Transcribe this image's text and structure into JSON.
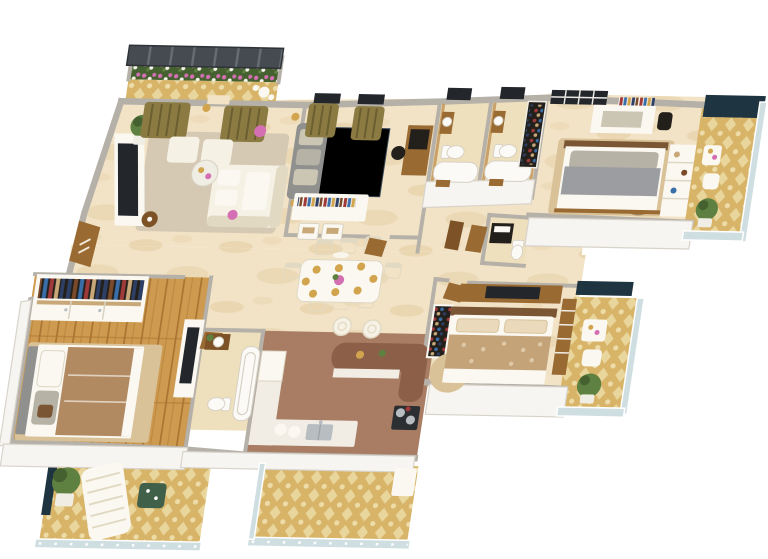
{
  "meta": {
    "view": "3d-isometric-floor-plan",
    "units_note": "no text rendered in source image"
  },
  "palette": {
    "bg": "#ffffff",
    "wall_top": "#b5b1a9",
    "wall_face": "#f7f5f1",
    "wall_shadow": "#d8d3ca",
    "wall_tan": "#c9a168",
    "marble": "#f2e3c6",
    "marble_streak": "#e2cb9e",
    "bath_floor": "#efe0bd",
    "carpet": "#d5c9b4",
    "wood": "#cd9a4f",
    "wood_line": "#a97431",
    "terracotta": "#a97d64",
    "damask": "#d8b468",
    "damask_motif": "#eddca7",
    "roof": "#454b51",
    "roof_stripe": "#666d74",
    "window": "#23262b",
    "mullion": "#e9e7e1",
    "glass_dark": "#1e3440",
    "rail_glass": "#cfdee1",
    "curtain": "#8b7b43",
    "curtain_dark": "#6b5e30",
    "sofa": "#f6f1e5",
    "sofa_shadow": "#e2d9c3",
    "gray_sofa": "#90908f",
    "cushion": "#cbc5b3",
    "bed_master": "#b28a62",
    "linen": "#faf8f1",
    "headboard": "#7a5634",
    "pillow_gray": "#b7b2a6",
    "bed2": "#9c9da1",
    "bed3": "#c4a379",
    "bed3_motif": "#ead9ba",
    "counter_brown": "#8c5f48",
    "island": "#f1ede4",
    "steel": "#b7bdc1",
    "cooktop": "#2c2f32",
    "door": "#9a6a33",
    "door_dark": "#7c5226",
    "plant": "#5e8040",
    "plant_dark": "#456130",
    "pot": "#f0ede5",
    "gold": "#d1a44d",
    "pink": "#d56fb4",
    "toilet": "#fbfaf7",
    "fixture": "#d7d1c5",
    "dark": "#23201c",
    "rug_a": "#5c6d7c",
    "rug_b": "#3f5062",
    "rug_c": "#95a1ab",
    "rug_d": "#7b6a55",
    "clothes_a": "#2e3f66",
    "clothes_b": "#7b4a2a",
    "clothes_c": "#3a6ea8",
    "clothes_d": "#a03a3a",
    "clothes_e": "#c8a878",
    "tan_rug": "#d9c198",
    "table_green": "#41604a",
    "white": "#ffffff"
  },
  "scene": {
    "type": "apartment-floor-plan-3d-render",
    "background": "#ffffff",
    "rooms": [
      {
        "name": "living-balcony",
        "features": [
          "pergola-roof",
          "flower-planter",
          "damask-floor",
          "bistro-set"
        ]
      },
      {
        "name": "living-room",
        "furniture": [
          "l-shaped-white-sofa",
          "two-ottomans",
          "glass-coffee-table",
          "tv-console",
          "topiary-plant",
          "olive-curtains",
          "area-rug",
          "side-table",
          "flower-vases"
        ]
      },
      {
        "name": "family-lounge",
        "furniture": [
          "gray-sofa",
          "patchwork-blue-rug",
          "gold-floor-lamps",
          "media-console-with-books",
          "writing-desk",
          "olive-curtains",
          "drawer-chests"
        ]
      },
      {
        "name": "foyer",
        "features": [
          "entrance-door",
          "marble-floor"
        ]
      },
      {
        "name": "dining-room",
        "furniture": [
          "white-dining-table",
          "eight-place-settings",
          "upholstered-chairs",
          "centerpiece-flowers",
          "pendant-lamp"
        ]
      },
      {
        "name": "kitchen",
        "furniture": [
          "curved-breakfast-island",
          "bar-stools",
          "gas-cooktop",
          "sink-counter",
          "refrigerator",
          "terracotta-floor"
        ]
      },
      {
        "name": "bathroom-1",
        "fixtures": [
          "toilet",
          "bathtub",
          "vanity",
          "window"
        ]
      },
      {
        "name": "bathroom-2",
        "fixtures": [
          "toilet",
          "bathtub",
          "vanity",
          "window"
        ]
      },
      {
        "name": "powder-room",
        "fixtures": [
          "dark-vanity",
          "toilet",
          "doors"
        ]
      },
      {
        "name": "hallway",
        "features": [
          "display-cabinet",
          "marble-floor"
        ]
      },
      {
        "name": "master-bedroom",
        "furniture": [
          "double-bed-brown-duvet",
          "open-wardrobe-with-clothes",
          "tv-dresser",
          "wood-plank-floor",
          "tan-rug"
        ]
      },
      {
        "name": "master-bathroom",
        "fixtures": [
          "bathtub",
          "toilet",
          "wood-vanity",
          "plant",
          "door"
        ]
      },
      {
        "name": "master-balcony",
        "features": [
          "wicker-lounge-chair",
          "green-table",
          "potted-plant",
          "glass-railing",
          "damask-floor",
          "privacy-panel"
        ]
      },
      {
        "name": "bedroom-2",
        "furniture": [
          "gray-double-bed",
          "circle-pattern-rug",
          "study-desk",
          "book-shelf",
          "wardrobe-shelving",
          "skylight-window"
        ]
      },
      {
        "name": "bedroom-2-balcony",
        "features": [
          "privacy-glass-panel",
          "cafe-table",
          "chair",
          "potted-plant",
          "railing"
        ]
      },
      {
        "name": "bedroom-3",
        "furniture": [
          "double-bed-patterned-quilt",
          "tv-console",
          "shoe-cabinet",
          "ladder-dresser",
          "bordered-rug"
        ]
      },
      {
        "name": "bedroom-3-balcony",
        "features": [
          "privacy-glass-panel",
          "desk",
          "chair",
          "potted-plant",
          "glass-railing"
        ]
      },
      {
        "name": "utility-balcony",
        "features": [
          "damask-floor",
          "glass-railing",
          "utility-unit"
        ]
      }
    ]
  }
}
